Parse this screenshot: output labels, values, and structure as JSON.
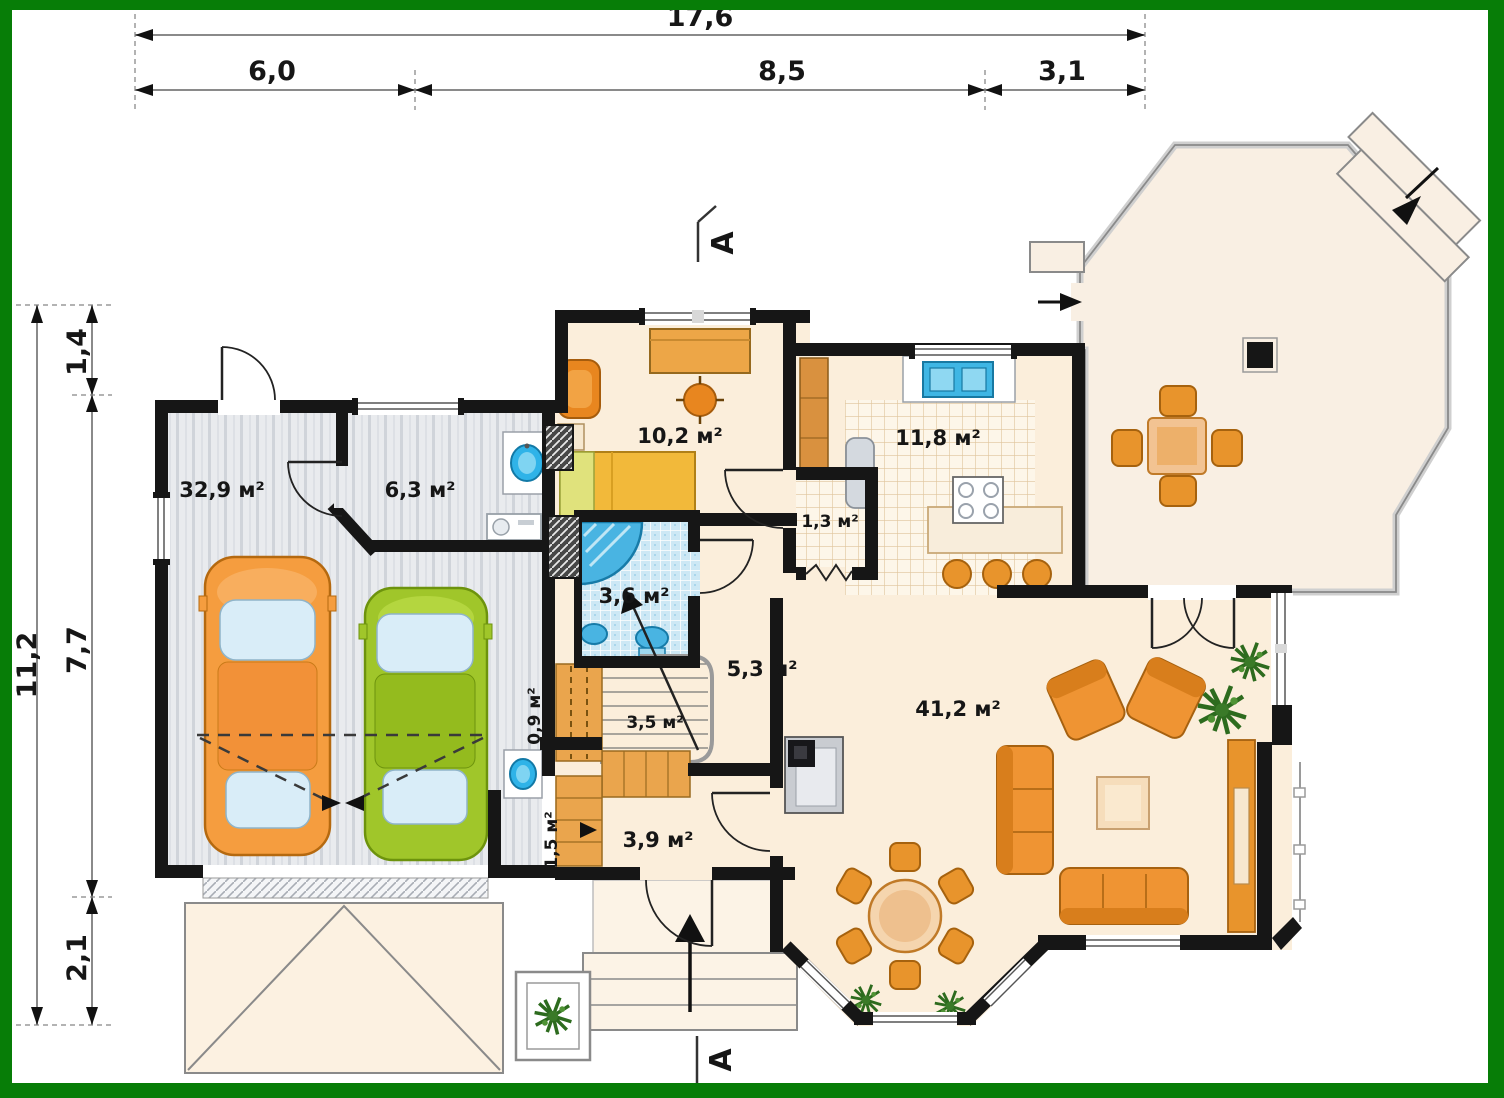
{
  "frame": {
    "border_color": "#077d07"
  },
  "dimensions": {
    "top_total": "17,6",
    "top_segments": [
      "6,0",
      "8,5",
      "3,1"
    ],
    "left_total": "11,2",
    "left_segments": [
      "1,4",
      "7,7",
      "2,1"
    ]
  },
  "areas": {
    "garage": "32,9 м²",
    "utility": "6,3 м²",
    "study": "10,2 м²",
    "kitchen": "11,8 м²",
    "wc": "1,3 м²",
    "bathroom": "3,6 м²",
    "hall": "5,3 м²",
    "closet": "0,9 м²",
    "stairs": "3,5 м²",
    "vestibule": "1,5 м²",
    "entry": "3,9 м²",
    "living_room": "41,2 м²"
  },
  "section_markers": {
    "top": "A",
    "bottom": "A"
  },
  "colors": {
    "frame_green": "#077d07",
    "wall_black": "#161616",
    "floor_cream": "#fbeedb",
    "terrace_floor": "#f9efe3",
    "garage_floor": "#e9ebee",
    "bath_tile_blue": "#cde8f5",
    "kitchen_tile": "#fbf2e2",
    "furniture_orange": "#ef9433",
    "car_orange": "#f59d3f",
    "car_green": "#a0c62a",
    "water_blue": "#2fb3e8",
    "plant_green": "#3a7a28"
  }
}
